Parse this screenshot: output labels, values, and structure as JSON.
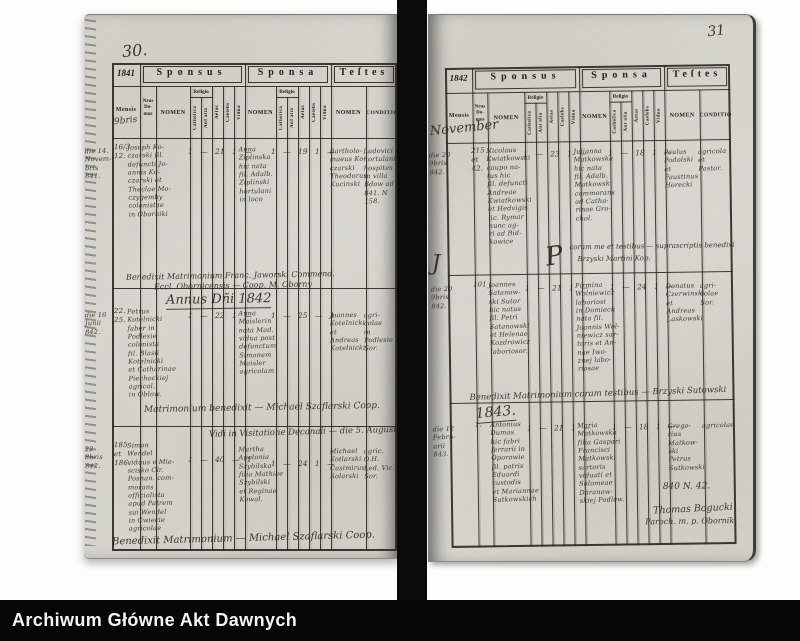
{
  "archive_bar": {
    "title": "Archiwum Główne Akt Dawnych"
  },
  "table_headers": {
    "sponsus": "Sponsus",
    "sponsa": "Sponsa",
    "testes": "Teſtes",
    "mensis": "Mensis",
    "nrus_domus": "Nrus\nDo-\nmus",
    "nomen": "NOMEN",
    "religio": "Religio",
    "catholica": "Catholica",
    "aut_alia": "Aut alia",
    "aetas": "Aetas",
    "caelebs": "Caelebs",
    "vidua": "Vidua",
    "conditio": "CONDITIO"
  },
  "left_page": {
    "page_number": "30.",
    "year": "1841",
    "mensis_note": "9bris",
    "entries": [
      {
        "date": "die 14.\nNovem-\nbris\n841.",
        "house": "16/3\n12.",
        "sponsus_name": "Joseph Ko-\nczarski fil.\ndefuncti Jo-\nannis Ko-\nczarski et\nTheclae Mo-\nczygemby\ncolonistae\nin Oborniki",
        "sponsus_marks": "1 — 21 1 —",
        "sponsa_name": "Anna\nZiplinska\nhic nata\nfil. Adalb.\nZiplinski\nhortulani\nin loco",
        "sponsa_marks": "1 — 19 1 —",
        "testes": "Bartholo-\nmaeus Ko-\nczarski\nTheodorus\nKucinski",
        "conditio": "Ludovici\nhortulani\nhospites\nin villa\nBdow ad\n841. N 158."
      },
      {
        "date": "die 16\nJunii\n842.",
        "house": "22.\n25.",
        "sponsus_name": "Petrus\nKotelnicki\nfaber in\nPodlesie\ncolonista\nfil. Blasii\nKotelnicki\net Catharinae\nPiechockiej\nagricol.\nin Oblow.",
        "sponsus_marks": "1 — 22 1 —",
        "sponsa_name": "Anna\nMaislerin\nnata Mad.\nvidua post\ndefunctum\nSimonem\nMaisler\nagricolam",
        "sponsa_marks": "1 — 25 — 1",
        "testes": "Joannes\nKotelnicki\net\nAndreas\nKotelnicki",
        "conditio": "agri-\ncolae\nin Podlesie\nSor."
      },
      {
        "date": "22 8bris\n842.",
        "house": "185\net\n186.",
        "sponsus_name": "Simon\nWendel\nviduus e Mie-\nscisko Cir.\nPosnan. com-\nmorans\nofficialista\napud Patrem\nsui Wendel\nin Cwiecie\nagricolae",
        "sponsus_marks": "1 — 40 — 1",
        "sponsa_name": "Martha\nApolonia\nSzybilska\nfilia Mathiae\nSzybilski\net Reginae\nKowal.",
        "sponsa_marks": "1 — 24 1 —",
        "testes": "Michael\nKotlarski\nCasimirus\nSolarski",
        "conditio": "agric.\nO.H.\nLed. Vic.\nSor."
      }
    ],
    "note_1a": "Benedixit Matrimonium Franc. Jaworski Commend.",
    "note_1b": "Eccl. Obornicensis — Coop. M. Oborny",
    "annus_divider": "Annus Dñi 1842",
    "mid_signature": "Matrimonium benedixit — Michael Szaflarski Coop.",
    "visitation_note": "Vidi in Visitatione Decanali — die 5. Augusti 842.",
    "bottom_signature": "Benedixit Matrimonium — Michael Szaflarski Coop."
  },
  "right_page": {
    "page_number": "31",
    "year": "1842",
    "mensis_note": "November",
    "paraph": "P",
    "paraph2": "J",
    "entries": [
      {
        "date": "die 20\n9bris\n842.",
        "house": "215\net\n42.",
        "sponsus_name": "Nicolaus\nKwiatkowski\ncaupo na-\ntus hic\nfil. defuncti\nAndreae\nKwiatkowski\net Hedvigis\nlic. Rymar\nnunc ag-\nri ad Bid-\nkowice",
        "sponsus_marks": "1 — 23 1 —",
        "sponsa_name": "Julianna\nMatkowska\nhic nata\nfil. Adalb.\nMatkowski\ncommorans\nad Catha-\nrinae Gro-\nchol.",
        "sponsa_marks": "1 — 18 1 —",
        "testes": "Paulus\nPodolski\net\nFaustinus\nHorecki",
        "conditio": "agricola\net\nPastor."
      },
      {
        "date": "die 20\n9bris\n842.",
        "house": "101",
        "sponsus_name": "Joannes\nSatanow-\nski Sutor\nhic natus\nfil. Petri\nSatanowski\net Helenae\nKozdrowicz\nlaboriosor.",
        "sponsus_marks": "1 — 21 1 —",
        "sponsa_name": "Firmina\nWolniewicz\nlaboriosi\nin Domiech\nnata fil.\nJoannis Wol-\nniewicz sar-\ntoris et An-\nnae Iwo-\nznej labo-\nriosae",
        "sponsa_marks": "1 — 24 1 —",
        "testes": "Donatus\nCzerwinski\net Andreas\nLaskowski",
        "conditio": "agri-\ncolae\nSor."
      },
      {
        "date": "die 12\nFebru-\narii\n843.",
        "house": "1.",
        "sponsus_name": "Antonius\nDumas\nhic fabri\nferrarii in\nOporowie\nfil. patris\nEduardi\ncustodis\net Mariannae\nSutkowskich",
        "sponsus_marks": "1 — 21 1 —",
        "sponsa_name": "Maria\nMatkowska\nfilia Gaspari\nFrancisci\nMatkowski\nsartoris\nviduati et\nSalomeae\nDaranow-\nskiej Podlew.",
        "sponsa_marks": "1 — 18 1 —",
        "testes": "Grego-\nrius\nMatkow-\nski\nPetrus\nSutkowski",
        "conditio": "agricolae"
      }
    ],
    "note_1a": "coram me et testibus — suprascriptis benedixi",
    "note_1b": "Brzyski Martini Kop.",
    "note_2": "Benedixit Matrimonium coram testibus — Brzyski Sutowski",
    "year_divider": "1843.",
    "ref_note": "840 N. 42.",
    "signature_1": "Thomas Bogucki",
    "signature_2": "Paroch. m. p. Obornik"
  }
}
